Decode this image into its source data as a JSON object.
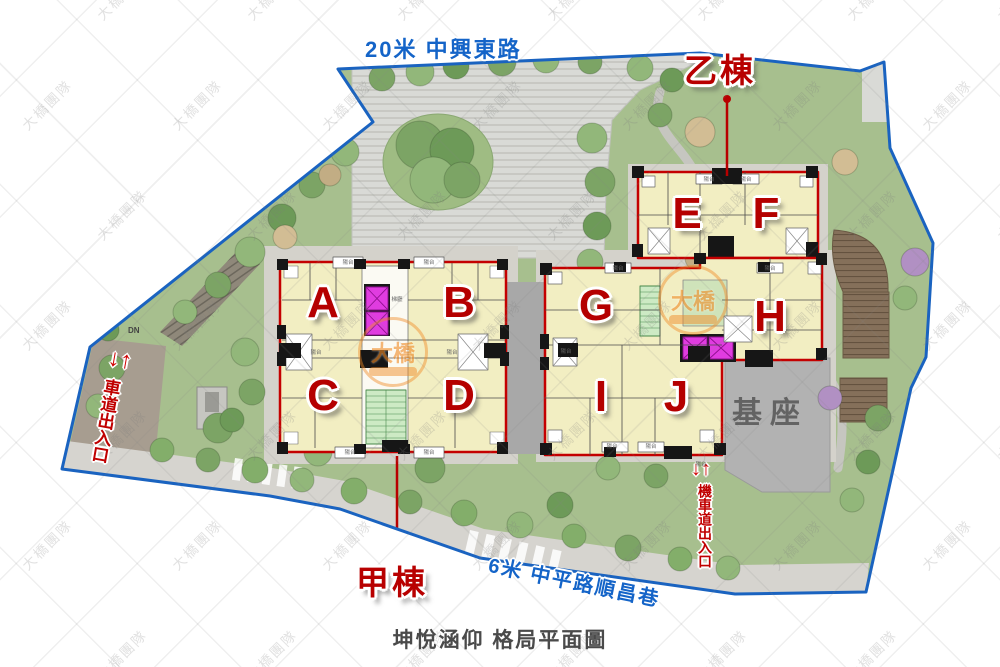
{
  "page_title": "坤悅涵仰 格局平面圖",
  "roads": {
    "top": "20米 中興東路",
    "bottom": "6米 中平路順昌巷"
  },
  "building_labels": {
    "jia": "甲棟",
    "yi": "乙棟"
  },
  "unit_letters": [
    "A",
    "B",
    "C",
    "D",
    "E",
    "F",
    "G",
    "H",
    "I",
    "J"
  ],
  "entrances": {
    "car": "車道出入口",
    "moto": "機車道出入口",
    "arrows": "↓↑"
  },
  "annotations": {
    "podium": "基座",
    "ramp": "DN",
    "balcony": "陽台",
    "core_note": "梯廳"
  },
  "watermark": {
    "tile": "大橋團隊",
    "logo": "大橋"
  },
  "colors": {
    "boundary_blue": "#1a63c0",
    "road_blue": "#1464c8",
    "accent_red": "#b80000",
    "unit_cream": "#f2eec2",
    "elevator_magenta": "#e03ce0",
    "stair_green": "#cdeac4",
    "landscape_green": "#a7bf8e",
    "plaza_gray": "#d9dad6",
    "podium_gray": "#b2b2b2"
  }
}
